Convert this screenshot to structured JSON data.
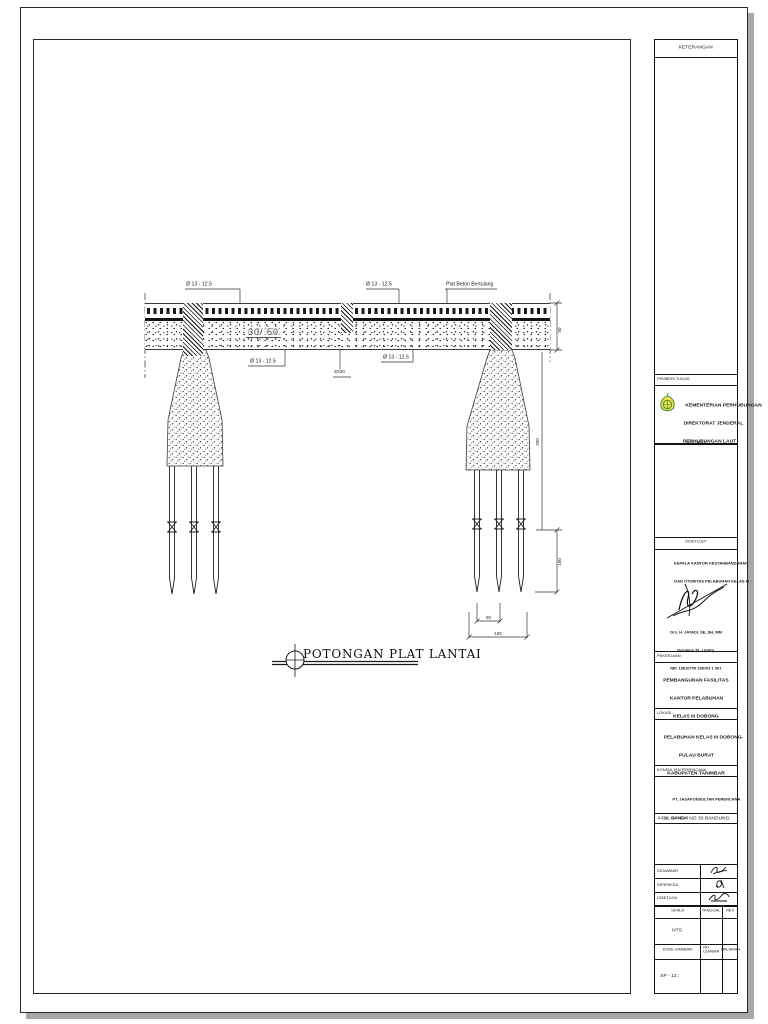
{
  "drawing": {
    "title": "POTONGAN PLAT LANTAI",
    "rebar_label": "Ø 13 - 12.5",
    "slab_note": "Plat Beton Bertulang",
    "beam_size": "30/ 50",
    "small_beam_size": "20/30",
    "dims": {
      "beam_depth": "50",
      "pier_height": "250",
      "pile_upper": "150",
      "pile_gap": "50",
      "pile_total": "100"
    }
  },
  "titleblock": {
    "keterangan_header": "KETERANGAN",
    "pemberi_tugas_header": "PEMBERI TUGAS",
    "ministry_line1": "KEMENTERIAN PERHUBUNGAN",
    "ministry_line2": "DIREKTORAT JENDERAL",
    "ministry_line3": "PERHUBUNGAN LAUT",
    "ministry_sub": "DIKETAHUI",
    "disetujui_header": "DISETUJUI",
    "approver_title_line1": "KEPALA KANTOR KESYAHBANDARAN",
    "approver_title_line2": "DAN OTORITAS PELABUHAN KELAS III",
    "approver_name": "Drs. H. JAYADI, SE, SH, MM",
    "approver_rank": "Pembina Tk. I (IV/b)",
    "approver_nip": "NIP. 19610705 198703 1 001",
    "pekerjaan_header": "PEKERJAAN :",
    "pekerjaan_line1": "PEMBANGUNAN FASILITAS",
    "pekerjaan_line2": "KANTOR PELABUHAN",
    "pekerjaan_line3": "KELAS III DOBONG",
    "lokasi_header": "LOKASI :",
    "lokasi_line1": "PELABUHAN KELAS III DOBONG-",
    "lokasi_line2": "PULAU BURAT",
    "lokasi_line3": "KABUPATEN TANIMBAR",
    "konsultan_header": "KONSULTAN PERENCANA",
    "konsultan_name": "PT. JASAKONSULTAN PERENCANA",
    "konsultan_address": "JL. BANDA NO 30 BANDUNG",
    "judul_header": "JUDUL GAMBAR",
    "row_digambar": "DIGAMBAR",
    "row_diperiksa": "DIPERIKSA",
    "row_disetujui": "DISETUJUI",
    "skala_header": "SKALA",
    "tanggal_header": "TANGGAL",
    "rev_header": "REV",
    "skala_value": "NTS",
    "kode_gambar_header": "KODE GAMBAR",
    "no_lembar_header": "NO. LEMBAR",
    "halaman_header": "HALAMAN",
    "kode_gambar_value": "SP - 12 :"
  },
  "colors": {
    "line": "#1a1a1a",
    "logo_yellow": "#efe04b",
    "logo_green": "#2e7d32"
  }
}
